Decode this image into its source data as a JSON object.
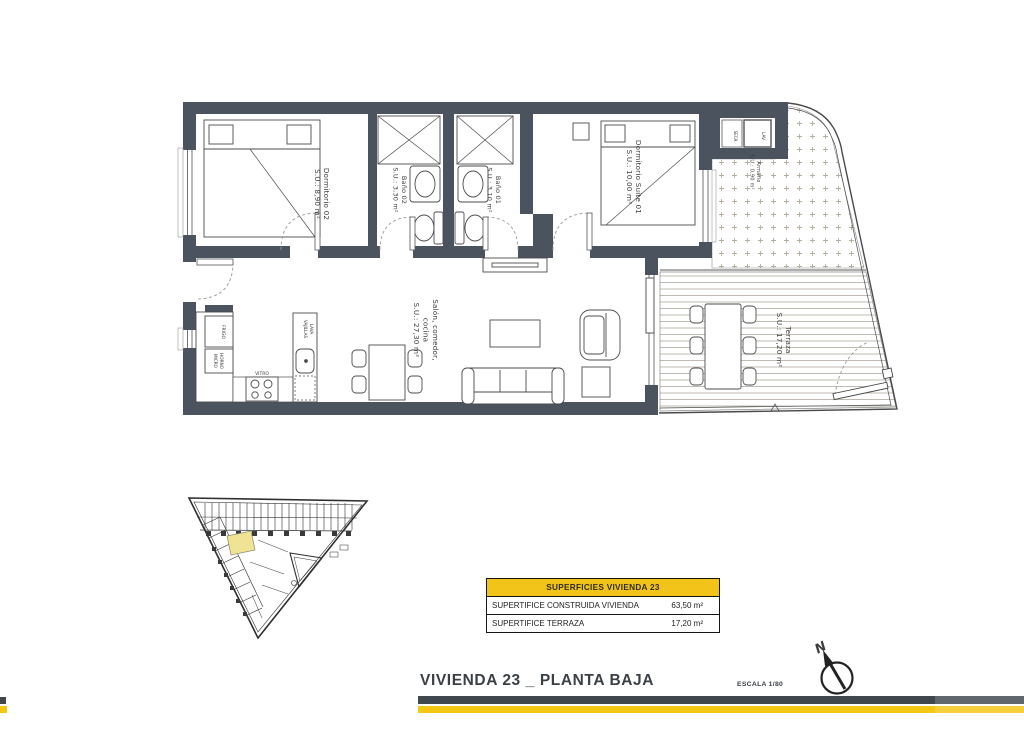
{
  "colors": {
    "wall": "#4a535e",
    "accent_yellow": "#f2c41a",
    "bar_dark": "#40474d",
    "bar_dark_light": "#61686d",
    "bar_yellow": "#f4c715",
    "bar_yellow_light": "#f7cf3d",
    "highlight_unit": "#f0e494"
  },
  "floor_plan": {
    "rooms": {
      "dormitorio02": {
        "name": "Dormitorio 02",
        "area": "S.U.: 8,90 m²"
      },
      "bano02": {
        "name": "Baño 02",
        "area": "S.U.: 3,30 m²"
      },
      "bano01": {
        "name": "Baño 01",
        "area": "S.U.: 3,10 m²"
      },
      "suite01": {
        "name": "Dormitorio Suite 01",
        "area": "S.U.: 10,00 m²"
      },
      "armario": {
        "name": "Armario",
        "area": "S.U.: 0,90 m²"
      },
      "salon": {
        "line1": "Salón, comedor,",
        "line2": "cocina",
        "area": "S.U.: 27,30 m²"
      },
      "terraza": {
        "name": "Terraza",
        "area": "S.U.: 17,20 m²"
      }
    },
    "appliances": {
      "lav": "LAV",
      "seca": "SECA",
      "frigo": "FRIGO",
      "horno_line1": "HORNO",
      "horno_line2": "MICRO",
      "vitro": "VITRO",
      "lv_line1": "LAVA",
      "lv_line2": "VAJILLAS"
    }
  },
  "surfaces_table": {
    "header": "SUPERFICIES VIVIENDA 23",
    "rows": [
      {
        "label": "SUPERTIFICE CONSTRUIDA VIVIENDA",
        "value": "63,50 m²"
      },
      {
        "label": "SUPERTIFICE TERRAZA",
        "value": "17,20 m²"
      }
    ]
  },
  "footer": {
    "title": "VIVIENDA 23 _ PLANTA BAJA",
    "scale": "ESCALA 1/80",
    "north_label": "N"
  }
}
